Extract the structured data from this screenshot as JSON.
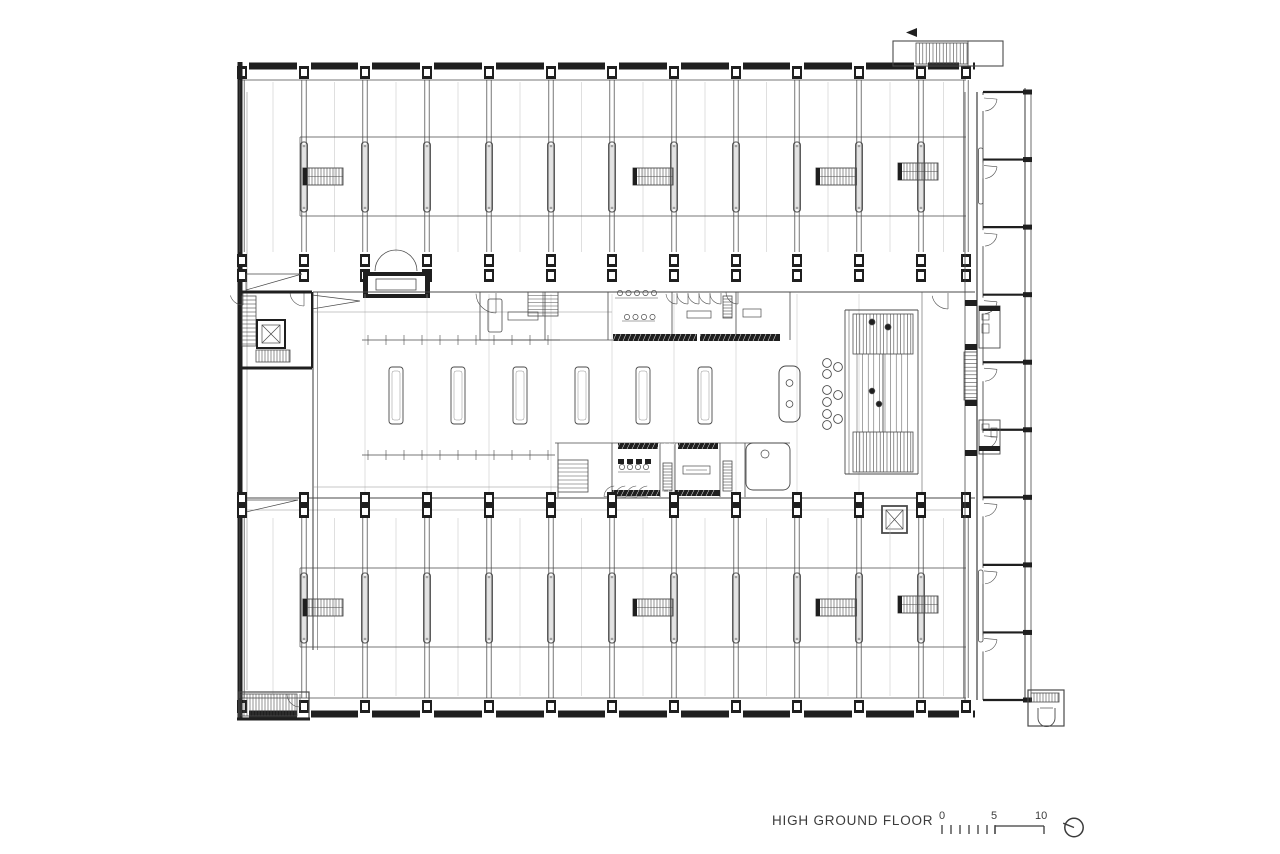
{
  "footer": {
    "title": "HIGH GROUND FLOOR",
    "scale": {
      "labels": [
        "0",
        "5",
        "10"
      ]
    },
    "north_icon": "north-arrow-icon"
  },
  "colors": {
    "ink": "#1f1f1f",
    "mid": "#4a4a4a",
    "light": "#8f8f8f",
    "faint": "#b8b8b8",
    "paper": "#ffffff",
    "label": "#3b3b3b"
  },
  "plan": {
    "type": "architectural-floor-plan",
    "bays_across_top": 12,
    "hall_tables": 6,
    "right_wing_rooms": 9,
    "ladder_count_per_band": 4,
    "seating_chair_circles": 9
  }
}
